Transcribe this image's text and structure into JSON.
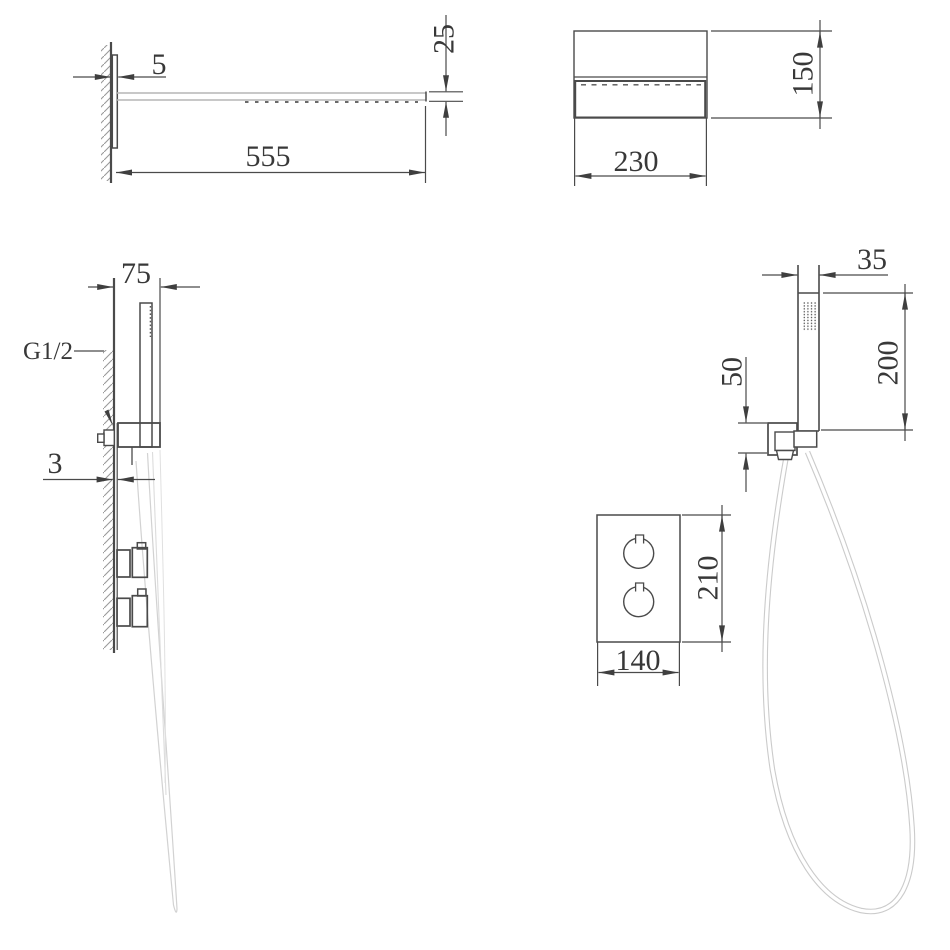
{
  "meta": {
    "drawing_type": "shower system installation dimension drawing",
    "units": "mm"
  },
  "dims": {
    "head_plate_thickness": "5",
    "head_length": "555",
    "head_thickness": "25",
    "head_width": "230",
    "head_height": "150",
    "hand_depth": "75",
    "thread": "G1/2",
    "wall_plate_thickness": "3",
    "hand_width": "35",
    "hand_height": "200",
    "outlet_height": "50",
    "valve_height": "210",
    "valve_width": "140"
  },
  "colors": {
    "line": "#4a4a4a",
    "light_line": "#b5b5b5",
    "hose": "#cbcbcb",
    "text": "#383838"
  }
}
